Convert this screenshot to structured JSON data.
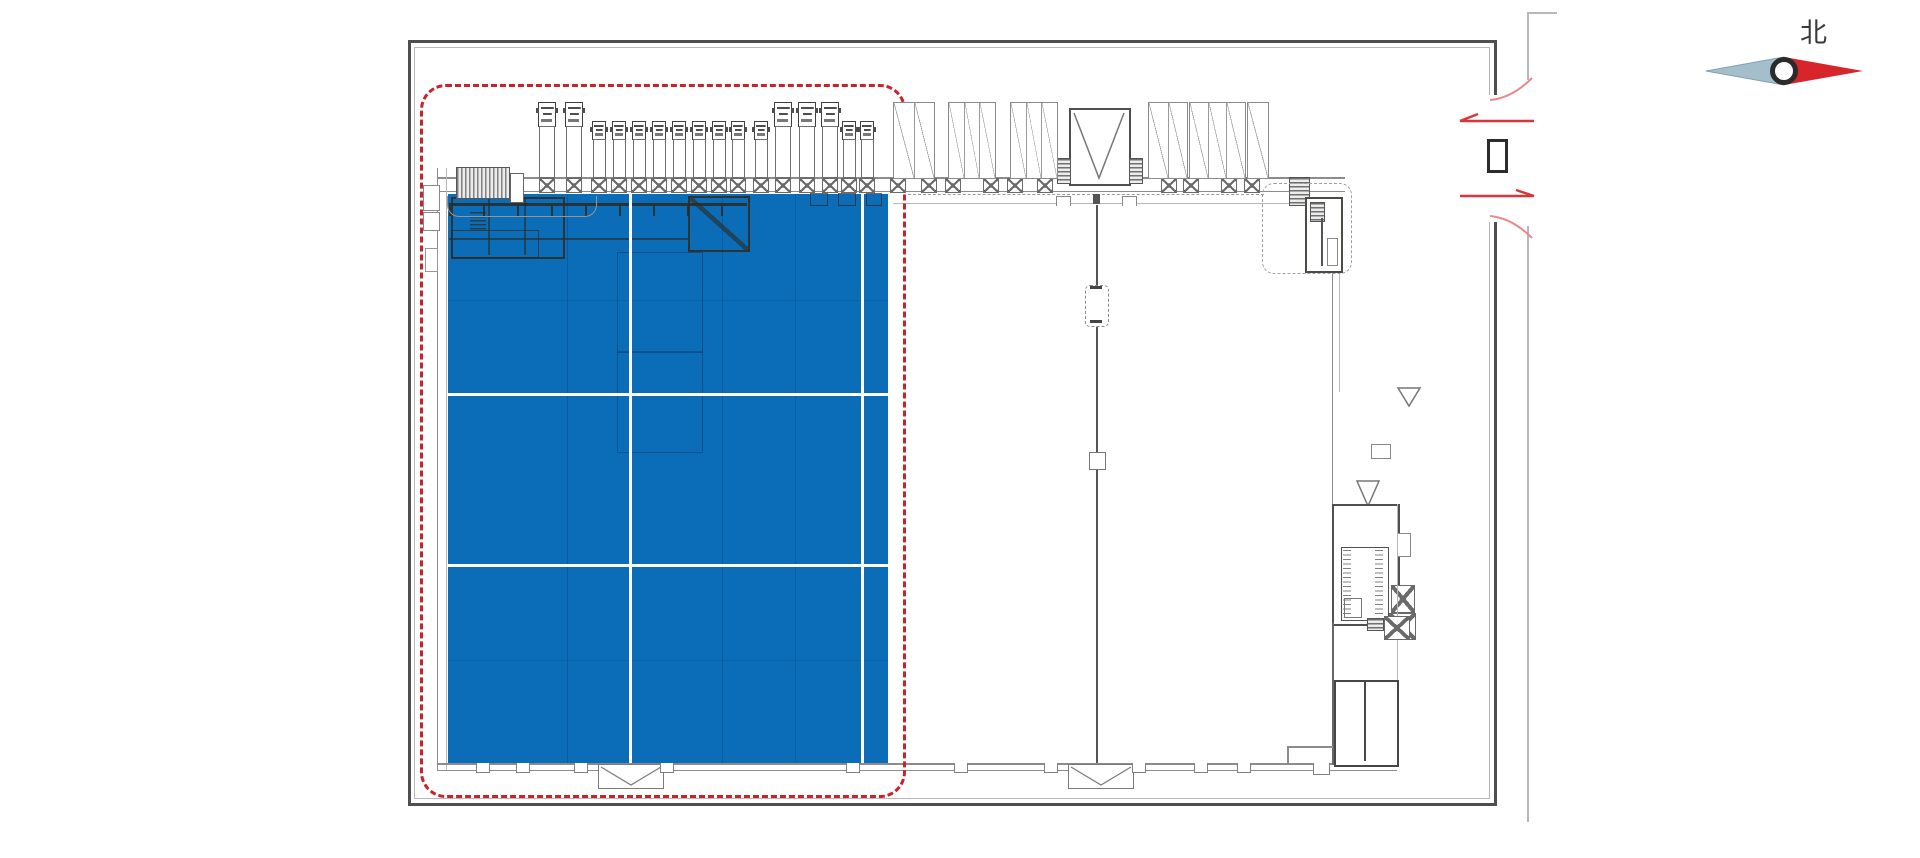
{
  "compass": {
    "label": "北"
  },
  "colors": {
    "highlight": "#0b6cb7",
    "zone_outline": "#c8232b",
    "flow_arrow": "#d6363c",
    "door_swing": "#e8898e",
    "frame": "#4f4f4f",
    "wall": "#8c8c8c",
    "wall_light": "#b8b8b8",
    "equipment": "#4d463c",
    "compass_north": "#d6252b",
    "compass_south": "#a5becb",
    "label_ink": "#3a3a3a"
  },
  "plan": {
    "highlight_zone": {
      "x": 448,
      "y": 194,
      "w": 440,
      "h": 569,
      "white_dividers_x": [
        630,
        862
      ],
      "white_dividers_y": [
        394,
        565
      ]
    },
    "outline_zone": {
      "x": 420,
      "y": 84,
      "w": 480,
      "h": 708
    },
    "trucks": [
      {
        "x": 546,
        "size": "large"
      },
      {
        "x": 573,
        "size": "large"
      },
      {
        "x": 598,
        "size": "small"
      },
      {
        "x": 618,
        "size": "small"
      },
      {
        "x": 638,
        "size": "small"
      },
      {
        "x": 658,
        "size": "small"
      },
      {
        "x": 678,
        "size": "small"
      },
      {
        "x": 698,
        "size": "small"
      },
      {
        "x": 718,
        "size": "small"
      },
      {
        "x": 737,
        "size": "small"
      },
      {
        "x": 760,
        "size": "small"
      },
      {
        "x": 782,
        "size": "large"
      },
      {
        "x": 806,
        "size": "large"
      },
      {
        "x": 829,
        "size": "large"
      },
      {
        "x": 848,
        "size": "small"
      },
      {
        "x": 866,
        "size": "small"
      }
    ],
    "wall_columns_x": [
      546,
      573,
      598,
      618,
      638,
      658,
      678,
      698,
      718,
      737,
      760,
      782,
      806,
      829,
      848,
      866,
      897,
      928,
      952,
      990,
      1014,
      1044,
      1168,
      1190,
      1228,
      1251
    ],
    "canopy_groups": [
      {
        "x": 893,
        "w": 40,
        "cells": 2
      },
      {
        "x": 948,
        "w": 46,
        "cells": 3
      },
      {
        "x": 1010,
        "w": 46,
        "cells": 3
      },
      {
        "x": 1148,
        "w": 38,
        "cells": 2
      },
      {
        "x": 1189,
        "w": 55,
        "cells": 3
      },
      {
        "x": 1247,
        "w": 20,
        "cells": 1
      }
    ],
    "dock_doors": [
      {
        "x": 598,
        "w": 64
      },
      {
        "x": 1068,
        "w": 64
      }
    ],
    "bumpers_x": [
      482,
      522,
      580,
      666,
      852,
      960,
      1050,
      1138,
      1200,
      1243
    ]
  },
  "gate": {
    "inbound_arrow": "left",
    "outbound_arrow": "right"
  }
}
